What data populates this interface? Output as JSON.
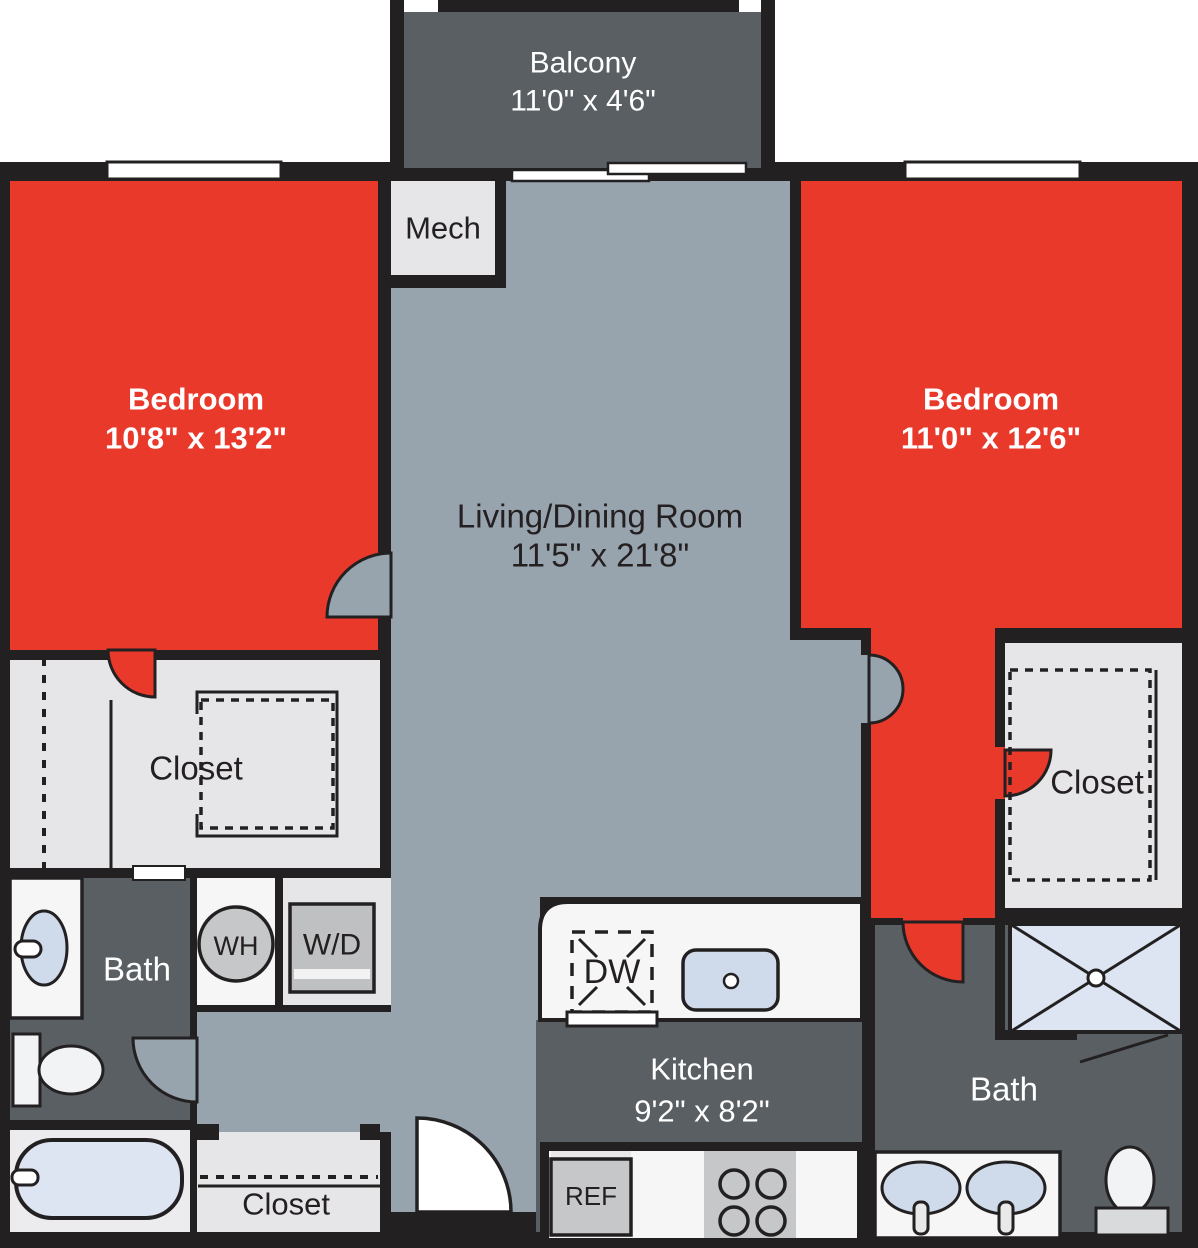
{
  "colors": {
    "wall": "#232021",
    "bedroom": "#e8392b",
    "living": "#97a4ae",
    "dark_room": "#5a5f64",
    "light_room": "#e6e6e8",
    "white_room": "#f6f6f7",
    "tub_room": "#ececee",
    "fixture_blue": "#cfdaeb",
    "fixture_blue_light": "#dde4f2",
    "appliance_gray": "#c6c7c9",
    "unit_gray": "#bfc0c2",
    "text_dark": "#242021",
    "text_light": "#ffffff"
  },
  "rooms": {
    "balcony": {
      "label": "Balcony",
      "dims": "11'0\" x 4'6\""
    },
    "bedroom_left": {
      "label": "Bedroom",
      "dims": "10'8\" x 13'2\""
    },
    "bedroom_right": {
      "label": "Bedroom",
      "dims": "11'0\" x 12'6\""
    },
    "living": {
      "label": "Living/Dining Room",
      "dims": "11'5\" x 21'8\""
    },
    "kitchen": {
      "label": "Kitchen",
      "dims": "9'2\" x 8'2\""
    },
    "mech": {
      "label": "Mech"
    },
    "closet_left": {
      "label": "Closet"
    },
    "closet_right": {
      "label": "Closet"
    },
    "closet_entry": {
      "label": "Closet"
    },
    "bath_left": {
      "label": "Bath"
    },
    "bath_right": {
      "label": "Bath"
    }
  },
  "fixtures": {
    "water_heater": "WH",
    "washer_dryer": "W/D",
    "dishwasher": "DW",
    "refrigerator": "REF"
  }
}
